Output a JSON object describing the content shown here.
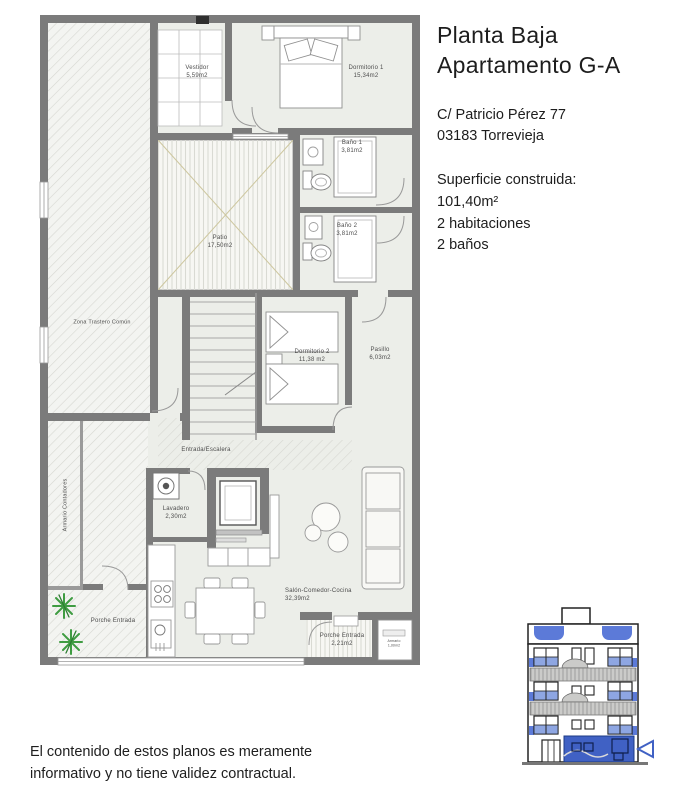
{
  "info_panel": {
    "title_line1": "Planta Baja",
    "title_line2": "Apartamento G-A",
    "address_line1": "C/ Patricio Pérez 77",
    "address_line2": "03183 Torrevieja",
    "surface_label": "Superficie construida:",
    "surface_value": "101,40m²",
    "rooms_count": "2 habitaciones",
    "baths_count": "2 baños"
  },
  "floorplan": {
    "rooms": {
      "vestidor": {
        "name": "Vestidor",
        "area": "5,59m2"
      },
      "dormitorio1": {
        "name": "Dormitorio 1",
        "area": "15,34m2"
      },
      "bano1": {
        "name": "Baño 1",
        "area": "3,81m2"
      },
      "patio": {
        "name": "Patio",
        "area": "17,50m2"
      },
      "bano2": {
        "name": "Baño 2",
        "area": "3,81m2"
      },
      "zona_trastero": {
        "name": "Zona Trastero Común"
      },
      "dormitorio2": {
        "name": "Dormitorio 2",
        "area": "11,38 m2"
      },
      "pasillo": {
        "name": "Pasillo",
        "area": "6,03m2"
      },
      "entrada": {
        "name": "Entrada/Escalera"
      },
      "armario_contadores": {
        "name": "Armario Contadores"
      },
      "lavadero": {
        "name": "Lavadero",
        "area": "2,30m2"
      },
      "porche_izq": {
        "name": "Porche Entrada"
      },
      "salon": {
        "name": "Salón-Comedor-Cocina",
        "area": "32,39m2"
      },
      "porche_der": {
        "name": "Porche Entrada",
        "area": "2,21m2"
      },
      "armario_peq": {
        "name": "Armario",
        "area": "1,00m2"
      }
    }
  },
  "disclaimer": {
    "line1": "El contenido de estos planos es meramente",
    "line2": "informativo y no tiene validez contractual."
  },
  "colors": {
    "wall_gray": "#7b7b7b",
    "floor_gray_green": "#eceee9",
    "highlight_blue": "#4061c4",
    "window_blue": "#8ea6e2",
    "plant_green": "#3f9c42",
    "patio_cross_olive": "#cdc79f"
  }
}
